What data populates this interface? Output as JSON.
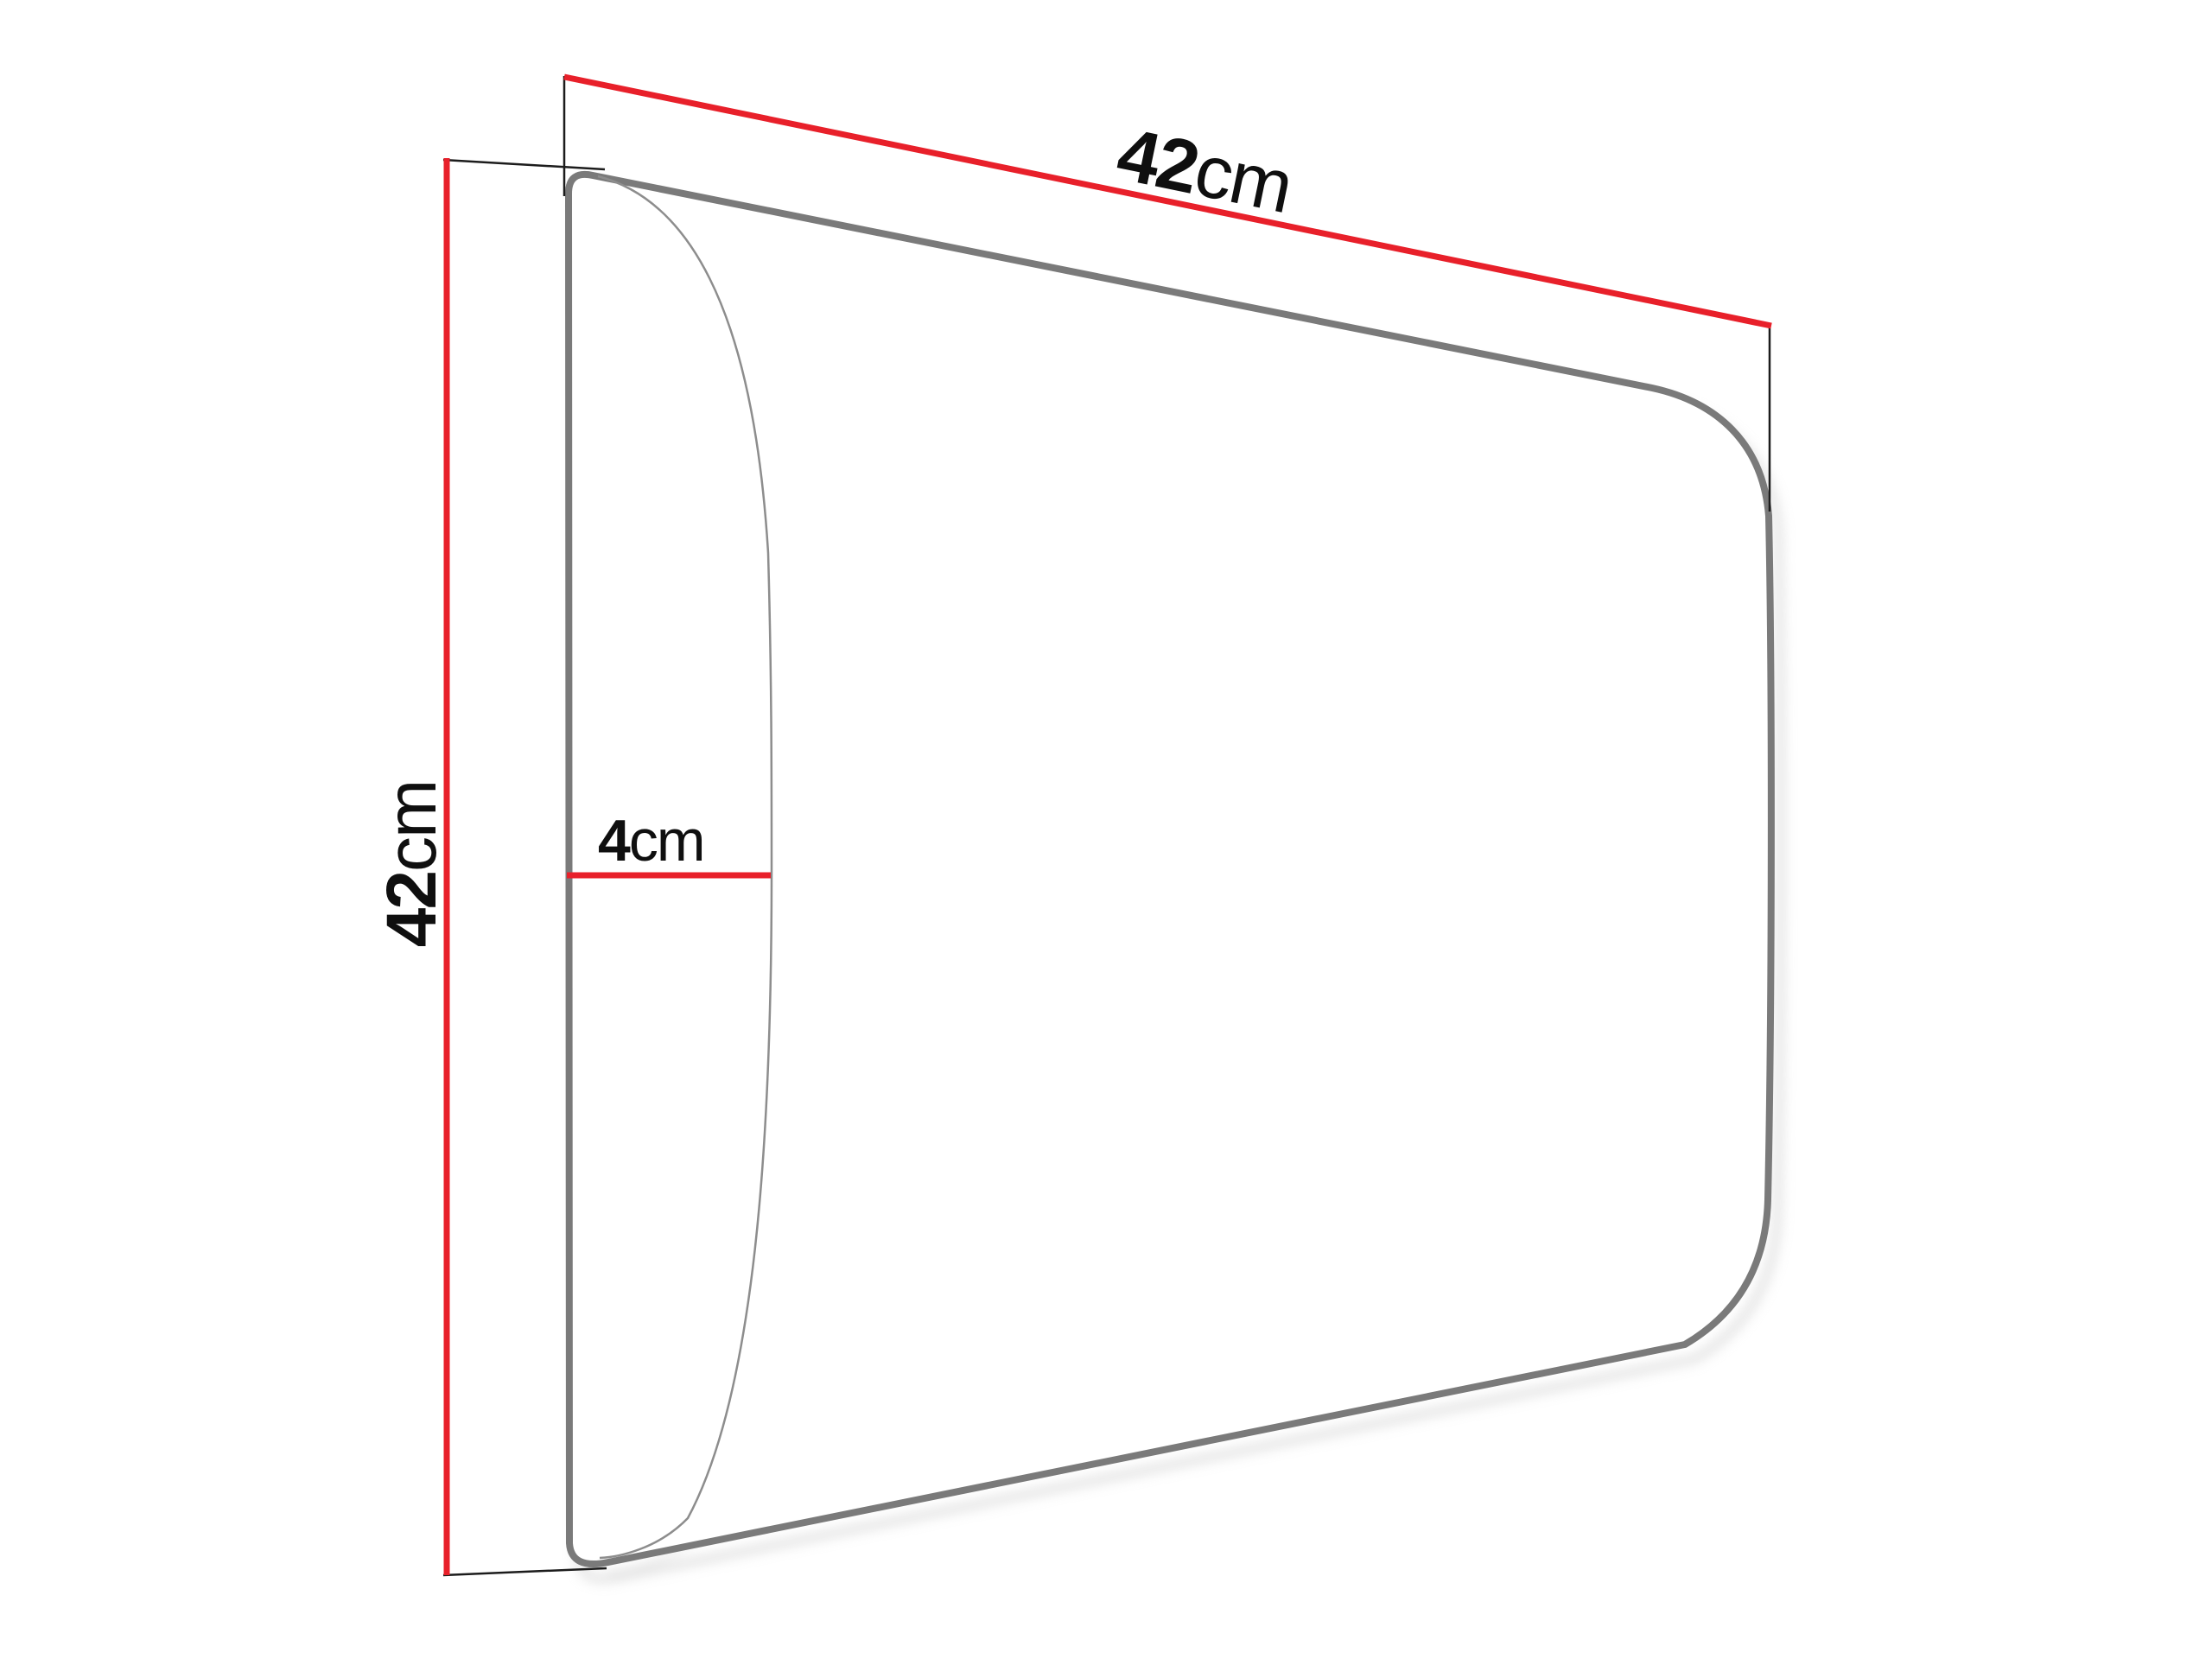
{
  "page": {
    "background_color": "#ffffff"
  },
  "diagram": {
    "kind": "upholstered-panel-dimension-drawing",
    "dimensions": {
      "width": {
        "value": "42",
        "unit": "cm"
      },
      "height": {
        "value": "42",
        "unit": "cm"
      },
      "depth": {
        "value": "4",
        "unit": "cm"
      }
    },
    "colors": {
      "dimension_line": "#e8202a",
      "panel_outline": "#7a7a7a",
      "bulge_line": "#8d8d8d",
      "extension_line": "#1c1c1c",
      "label_text": "#0f0f0f",
      "shadow": "#c6c6c6"
    }
  }
}
